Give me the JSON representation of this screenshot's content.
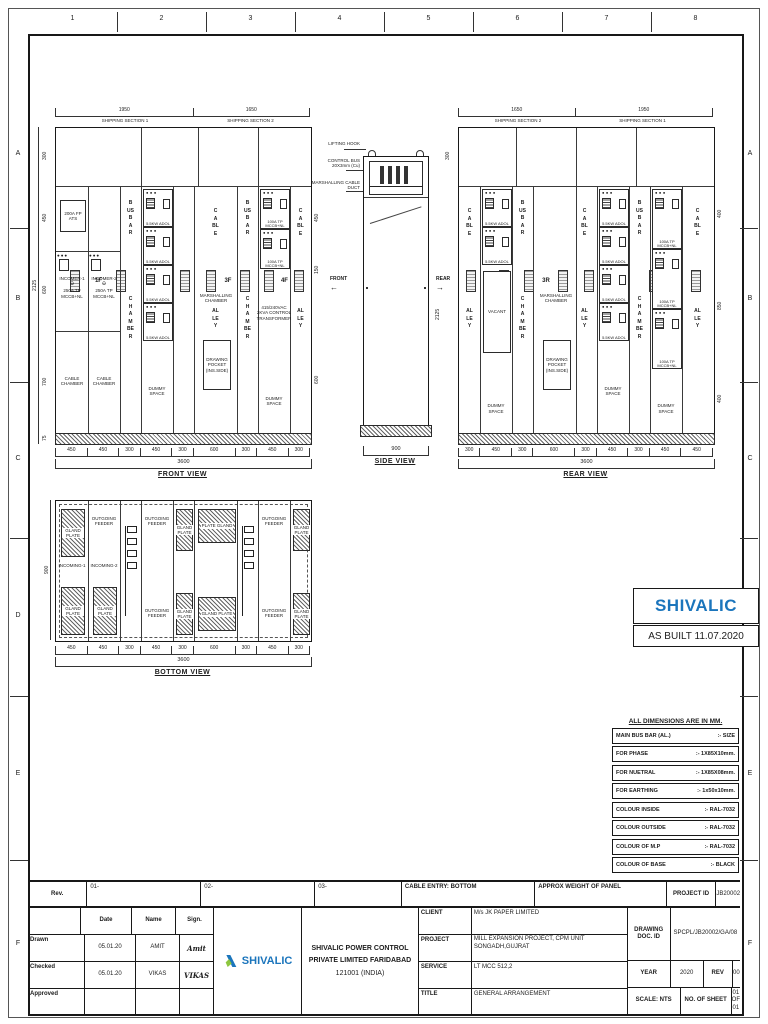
{
  "sheet": {
    "grid_cols": [
      "1",
      "2",
      "3",
      "4",
      "5",
      "6",
      "7",
      "8"
    ],
    "grid_rows": [
      "A",
      "B",
      "C",
      "D",
      "E",
      "F"
    ]
  },
  "shared": {
    "busbar": "BUSBAR",
    "chamber": "CHAMBER",
    "cable": "CABLE",
    "alley": "ALLEY",
    "marshalling": "MARSHALLING CHAMBER",
    "drawing_pocket": "DRAWING POCKET (INS.SIDE)",
    "dummy_space": "DUMMY SPACE",
    "cable_chamber": "CABLE CHAMBER",
    "vacant": "VACANT"
  },
  "front": {
    "name": "FRONT VIEW",
    "top_dims": [
      {
        "value": "1950",
        "label": "SHIPPING SECTION 1"
      },
      {
        "value": "1650",
        "label": "SHIPPING SECTION 2"
      }
    ],
    "panel_ids": [
      "1F",
      "2F",
      "3F",
      "4F"
    ],
    "bottom_dims": [
      "450",
      "450",
      "300",
      "450",
      "300",
      "600",
      "300",
      "450",
      "300"
    ],
    "total_width": "3600",
    "left_dims": [
      "300",
      "450",
      "600",
      "700",
      "75"
    ],
    "overall_height": "2125",
    "right_dims": [
      "450",
      "150",
      "600"
    ],
    "labels": {
      "ats": "200A FP ATS",
      "incomer1": "INCOMER-1",
      "incomer2": "INCOMER-2",
      "incomer_rating": "250A TP MCCB+NL",
      "feeder_rating": "100A TP MCCB+NL",
      "module": "5.5KW ADOL",
      "control_transformer": "415/240VAC 2KVA CONTROL TRANSFORMER"
    }
  },
  "side": {
    "name": "SIDE VIEW",
    "bottom_dim": "900",
    "lifting_hook": "LIFTING HOOK",
    "control_bus": "CONTROL BUS 20X3mm (Cu)",
    "marshalling_duct": "MARSHALLING CABLE DUCT",
    "front_label": "FRONT",
    "rear_label": "REAR",
    "front_arrow": "←",
    "rear_arrow": "→"
  },
  "rear": {
    "name": "REAR VIEW",
    "top_dims": [
      {
        "value": "1650",
        "label": "SHIPPING SECTION 2"
      },
      {
        "value": "1950",
        "label": "SHIPPING SECTION 1"
      }
    ],
    "panel_ids": [
      "4R",
      "3R",
      "2R",
      "1R"
    ],
    "bottom_dims": [
      "300",
      "450",
      "300",
      "600",
      "300",
      "450",
      "300",
      "450",
      "450"
    ],
    "total_width": "3600",
    "left_dims": [
      "300"
    ],
    "overall_height": "2125",
    "right_dims": [
      "400",
      "850",
      "400"
    ],
    "labels": {
      "feeder_rating": "100A TP MCCB+NL",
      "module": "5.5KW ADOL"
    }
  },
  "bottom": {
    "name": "BOTTOM VIEW",
    "bottom_dims": [
      "450",
      "450",
      "300",
      "450",
      "300",
      "600",
      "300",
      "450",
      "300"
    ],
    "total_width": "3600",
    "left_dim": "900",
    "labels": {
      "gland_plate": "GLAND PLATE",
      "plate_gland": "PLATE GLAND",
      "outgoing_feeder": "OUTGOING FEEDER",
      "incoming1": "INCOMING-1",
      "incoming2": "INCOMING-2"
    }
  },
  "brand_box": {
    "name": "SHIVALIC",
    "as_built": "AS BUILT 11.07.2020",
    "blue": "#1b75bc",
    "green": "#8dc63f"
  },
  "spec_table": {
    "title": "ALL DIMENSIONS ARE IN MM.",
    "rows": [
      {
        "k": "MAIN BUS BAR (AL.)",
        "v": ":- SIZE"
      },
      {
        "k": "FOR PHASE",
        "v": ":- 1X85X10mm."
      },
      {
        "k": "FOR NUETRAL",
        "v": ":- 1X85X08mm."
      },
      {
        "k": "FOR EARTHING",
        "v": ":- 1x50x10mm."
      },
      {
        "k": "COLOUR INSIDE",
        "v": ":- RAL-7032"
      },
      {
        "k": "COLOUR OUTSIDE",
        "v": ":- RAL-7032"
      },
      {
        "k": "COLOUR OF M.P",
        "v": ":- RAL-7032"
      },
      {
        "k": "COLOUR OF BASE",
        "v": ":- BLACK"
      }
    ]
  },
  "title_block": {
    "rev_label": "Rev.",
    "rev1": "01-",
    "rev2": "02-",
    "rev3": "03-",
    "cable_entry": "CABLE ENTRY: BOTTOM",
    "approx_weight": "APPROX WEIGHT OF PANEL",
    "project_id_label": "PROJECT ID",
    "project_id": "JB20002",
    "sign_table": {
      "date_h": "Date",
      "name_h": "Name",
      "sign_h": "Sign.",
      "rows": [
        {
          "role": "Drawn",
          "date": "05.01.20",
          "name": "AMIT",
          "sign": "Amit"
        },
        {
          "role": "Checked",
          "date": "05.01.20",
          "name": "VIKAS",
          "sign": "VIKAS"
        },
        {
          "role": "Approved",
          "date": "",
          "name": "",
          "sign": ""
        }
      ]
    },
    "company": {
      "logo_text": "SHIVALIC",
      "line1": "SHIVALIC POWER CONTROL",
      "line2": "PRIVATE LIMITED FARIDABAD",
      "line3": "121001 (INDIA)"
    },
    "info": {
      "client_label": "CLIENT",
      "client": "M/s JK PAPER LIMITED",
      "project_label": "PROJECT",
      "project": "MILL EXPANSION PROJECT, CPM UNIT SONGADH,GUJRAT",
      "service_label": "SERVICE",
      "service": "LT MCC 512,2",
      "title_label": "TITLE",
      "title": "GENERAL ARRANGEMENT",
      "doc_label": "DRAWING DOC. ID",
      "doc_id": "SPCPL/JB20002/GA/08",
      "year_label": "YEAR",
      "year": "2020",
      "rev_label": "REV",
      "rev": "00",
      "scale": "SCALE: NTS",
      "sheet_label": "NO. OF SHEET",
      "sheet": "01 OF 01"
    }
  }
}
